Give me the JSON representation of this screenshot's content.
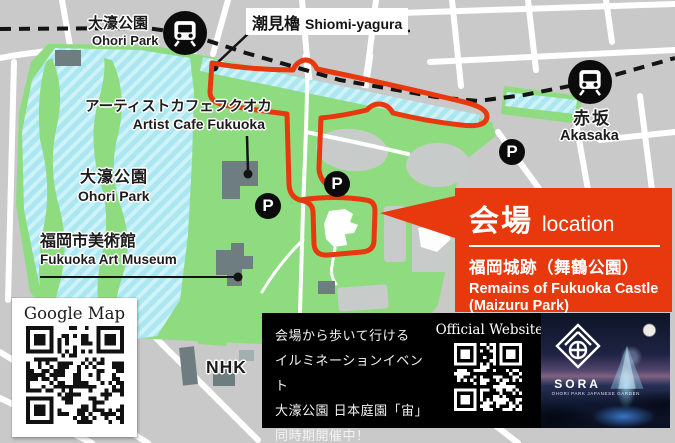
{
  "map": {
    "station_ohori": {
      "ja": "大濠公園",
      "en": "Ohori Park"
    },
    "station_akasaka": {
      "ja": "赤坂",
      "en": "Akasaka"
    },
    "shiomi_yagura": {
      "ja": "潮見櫓",
      "en": "Shiomi-yagura"
    },
    "artist_cafe": {
      "ja": "アーティストカフェフクオカ",
      "en": "Artist Cafe Fukuoka"
    },
    "ohori_park_lake": {
      "ja": "大濠公園",
      "en": "Ohori Park"
    },
    "art_museum": {
      "ja": "福岡市美術館",
      "en": "Fukuoka Art Museum"
    },
    "nhk": "NHK",
    "parking": "P"
  },
  "venue": {
    "heading_ja": "会場",
    "heading_en": "location",
    "name_ja": "福岡城跡（舞鶴公園）",
    "name_en1": "Remains of Fukuoka Castle",
    "name_en2": "(Maizuru Park)"
  },
  "google_map": {
    "title": "Google Map"
  },
  "banner": {
    "line1": "会場から歩いて行ける",
    "line2": "イルミネーションイベント",
    "line3": "大濠公園 日本庭園「宙」",
    "line4": "同時期開催中！",
    "official_website": "Official Website"
  },
  "sora": {
    "name": "SORA",
    "subtitle": "OHORI PARK JAPANESE GARDEN"
  },
  "colors": {
    "route_red": "#e8380d",
    "park_green": "#8edc7f",
    "water_blue": "#abe7f1",
    "city_gray": "#c9c9c9",
    "building_gray": "#6e7d80",
    "rail_black": "#141414"
  }
}
